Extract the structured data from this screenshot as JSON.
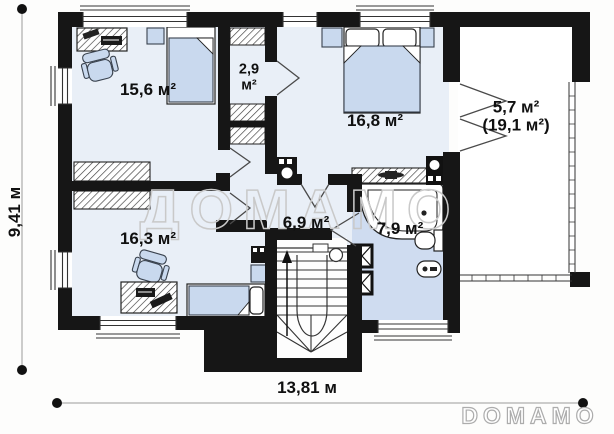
{
  "plan": {
    "watermark": "ДОМАМО",
    "brand_logo": "DOMAMO",
    "dimensions": {
      "total_width": "13,81 м",
      "total_height": "9,41 м"
    },
    "rooms": {
      "study_top": {
        "area": "15,6 м²"
      },
      "closet": {
        "area_value": "2,9",
        "area_unit": "м²"
      },
      "bedroom": {
        "area": "16,8 м²"
      },
      "terrace": {
        "area": "5,7 м²",
        "area_total": "(19,1 м²)"
      },
      "study_bottom": {
        "area": "16,3 м²"
      },
      "hall": {
        "area": "6,9 м²"
      },
      "bathroom": {
        "area": "7,9 м²"
      }
    },
    "colors": {
      "wall": "#161616",
      "room_floor": "#e9eff7",
      "bathroom_floor": "#cfdcf0",
      "furniture": "#c9d9ee",
      "watermark": "#c9c9c9"
    }
  }
}
